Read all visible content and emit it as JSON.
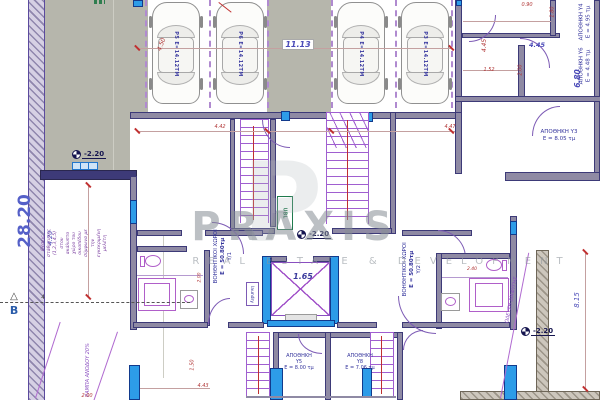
{
  "watermark": {
    "ghost": "P",
    "brand": "PRAXIS",
    "tagline": "REAL ESTATE & DEVELOPMENT"
  },
  "level_marks": {
    "value": "-2.20"
  },
  "section": {
    "label": "B",
    "tick": "4"
  },
  "parking": {
    "spots": [
      {
        "label": "Ρ5 Ε=14.12ΤΜ"
      },
      {
        "label": "Ρ6 Ε=14.12ΤΜ"
      },
      {
        "label": "Ρ4 Ε=14.12ΤΜ"
      },
      {
        "label": "Ρ3 Ε=14.12ΤΜ"
      }
    ]
  },
  "rooms": {
    "aux_left": {
      "name": "ΒΟΗΘΗΤΙΚΟΙ ΧΩΡΟΙ",
      "area": "Ε = 50.80τμ",
      "id": "Υ/1"
    },
    "aux_right": {
      "name": "ΒΟΗΘΗΤΙΚΟΙ ΧΩΡΟΙ",
      "area": "Ε = 50.80τμ",
      "id": "Υ/2"
    },
    "storage_y3": {
      "name": "ΑΠΟΘΗΚΗ Υ3",
      "area": "Ε = 8.05 τμ"
    },
    "storage_y4": {
      "name": "ΑΠΟΘΗΚΗ Υ4",
      "area": "Ε = 4.95 τμ"
    },
    "storage_y5": {
      "name": "ΑΠΟΘΗΚΗ",
      "id": "Υ5",
      "area": "Ε = 8.00 τμ"
    },
    "storage_y6": {
      "name": "ΑΠΟΘΗΚΗ Υ6",
      "area": "Ε = 4.48 τμ"
    },
    "storage_y8": {
      "name": "ΑΠΟΘΗΚΗ",
      "id": "Υ8",
      "area": "Ε = 7.06 τμ"
    },
    "laundry": {
      "name": "laundry"
    },
    "lift": {
      "name": "UBL"
    }
  },
  "notes": {
    "parking_note": "Θέσεις στάθμευσης (1,2,3,4,5) στον ακάλυπτο χώρο του οικοπέδου σύμφωνα με την εγκεκριμένη μελέτη",
    "ramp_left": "ΡΑΜΠΑ ΑΝΟΔΟΥ 20%",
    "ramp_right": "ΟΔΕΥΣΗ ΔΙΑΦΥΓΗΣ"
  },
  "dimensions": {
    "d450": "4.50",
    "d1113": "11.13",
    "d090": "0.90",
    "d180": "1.80",
    "d445a": "4.45",
    "d445b": "4.45",
    "d152": "1.52",
    "d200a": "2.00",
    "d680": "6.80",
    "d442": "4.42",
    "d447": "4.47",
    "d2820": "28.20",
    "d420": "4.20",
    "d165": "1.65",
    "d815": "8.15",
    "d200b": "2.00",
    "d443": "4.43",
    "d150": "1.50",
    "d200c": "2.00",
    "d240": "2.40"
  },
  "colors": {
    "ground": "#b6b6ac",
    "wall_fill": "#8f8aa4",
    "wall_edge": "#3d3a78",
    "opening_blue": "#2d9ce8",
    "line_purple": "#9b5fd0",
    "dim_red": "#b03434",
    "text_navy": "#34349c",
    "green": "#237a4b",
    "watermark_gray": "#8a9096"
  }
}
